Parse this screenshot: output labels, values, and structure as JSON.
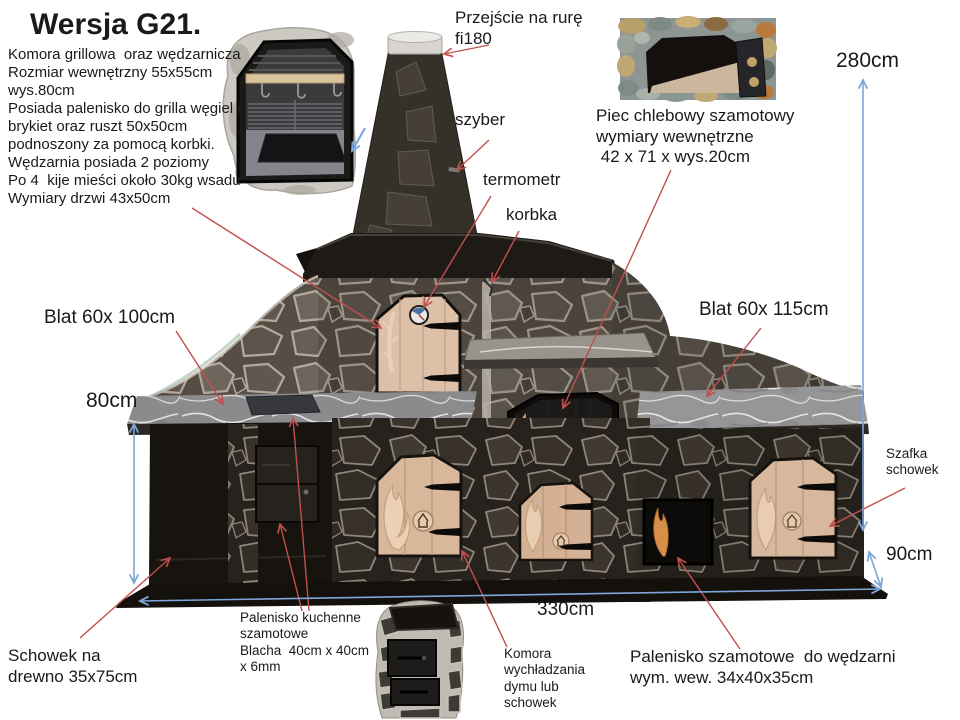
{
  "title": "Wersja G21.",
  "description": "Komora grillowa  oraz wędzarnicza\nRozmiar wewnętrzny 55x55cm\nwys.80cm\nPosiada palenisko do grilla węgiel i\nbrykiet oraz ruszt 50x50cm\npodnoszony za pomocą korbki.\nWędzarnia posiada 2 poziomy\nPo 4  kije mieści około 30kg wsadu\nWymiary drzwi 43x50cm",
  "labels": {
    "pipe_transition": "Przejście na rurę\nfi180",
    "szyber": "szyber",
    "termometr": "termometr",
    "korbka": "korbka",
    "bread_oven": "Piec chlebowy szamotowy\nwymiary wewnętrzne\n 42 x 71 x wys.20cm",
    "blat_left": "Blat 60x 100cm",
    "blat_right": "Blat 60x 115cm",
    "cabinet": "Szafka\nschowek",
    "wood_storage": "Schowek na\ndrewno 35x75cm",
    "kitchen_firebox": "Palenisko kuchenne\nszamotowe\nBlacha  40cm x 40cm\nx 6mm",
    "cooling_chamber": "Komora\nwychładzania\ndymu lub\nschowek",
    "smoker_firebox": "Palenisko szamotowe  do wędzarni\nwym. wew. 34x40x35cm"
  },
  "dimensions": {
    "total_height": "280cm",
    "counter_height": "80cm",
    "right_height": "90cm",
    "total_width": "330cm"
  },
  "colors": {
    "annotation_red": "#c0504d",
    "dimension_blue": "#7da7d9",
    "text": "#1a1a1a",
    "background": "#ffffff"
  }
}
